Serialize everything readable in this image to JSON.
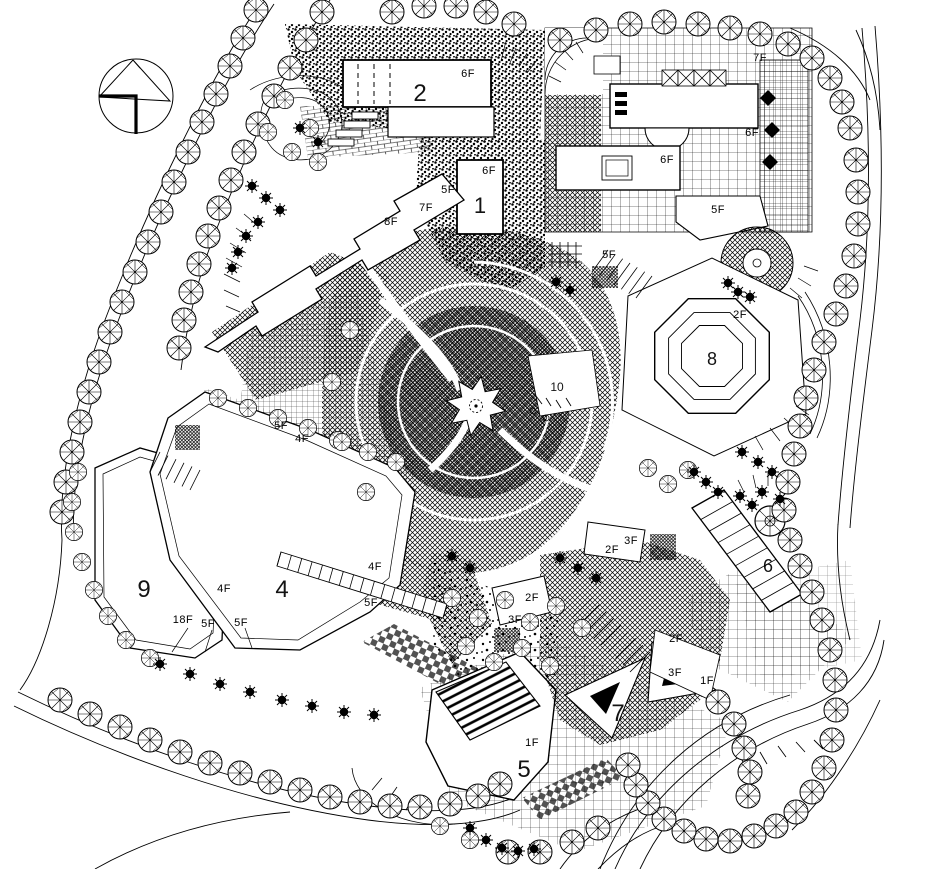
{
  "drawing": {
    "kind": "architectural masterplan site plan",
    "paper_color": "#ffffff",
    "ink_color": "#000000",
    "north_arrow_icon": "north-arrow"
  },
  "plan": {
    "building_numbers": [
      {
        "text": "1",
        "x": 480,
        "y": 213,
        "size": 22
      },
      {
        "text": "2",
        "x": 420,
        "y": 101,
        "size": 24
      },
      {
        "text": "4",
        "x": 282,
        "y": 597,
        "size": 24
      },
      {
        "text": "5",
        "x": 524,
        "y": 777,
        "size": 24
      },
      {
        "text": "6",
        "x": 768,
        "y": 572,
        "size": 18
      },
      {
        "text": "7",
        "x": 618,
        "y": 721,
        "size": 24
      },
      {
        "text": "8",
        "x": 712,
        "y": 365,
        "size": 18
      },
      {
        "text": "9",
        "x": 144,
        "y": 597,
        "size": 24
      },
      {
        "text": "10",
        "x": 557,
        "y": 391,
        "size": 12
      }
    ],
    "floor_labels": [
      {
        "text": "6F",
        "x": 468,
        "y": 77
      },
      {
        "text": "6F",
        "x": 489,
        "y": 174
      },
      {
        "text": "5F",
        "x": 448,
        "y": 193
      },
      {
        "text": "7F",
        "x": 426,
        "y": 211
      },
      {
        "text": "8F",
        "x": 391,
        "y": 225
      },
      {
        "text": "7F",
        "x": 760,
        "y": 61
      },
      {
        "text": "6F",
        "x": 752,
        "y": 136
      },
      {
        "text": "6F",
        "x": 667,
        "y": 163
      },
      {
        "text": "5F",
        "x": 718,
        "y": 213
      },
      {
        "text": "5F",
        "x": 609,
        "y": 258
      },
      {
        "text": "2F",
        "x": 740,
        "y": 318
      },
      {
        "text": "5F",
        "x": 281,
        "y": 429
      },
      {
        "text": "4F",
        "x": 302,
        "y": 442
      },
      {
        "text": "4F",
        "x": 375,
        "y": 570
      },
      {
        "text": "5F",
        "x": 371,
        "y": 606
      },
      {
        "text": "4F",
        "x": 224,
        "y": 592
      },
      {
        "text": "18F",
        "x": 183,
        "y": 623
      },
      {
        "text": "5F",
        "x": 208,
        "y": 627
      },
      {
        "text": "5F",
        "x": 241,
        "y": 626
      },
      {
        "text": "3F",
        "x": 631,
        "y": 544
      },
      {
        "text": "2F",
        "x": 612,
        "y": 553
      },
      {
        "text": "2F",
        "x": 532,
        "y": 601
      },
      {
        "text": "3F",
        "x": 515,
        "y": 623
      },
      {
        "text": "2F",
        "x": 676,
        "y": 642
      },
      {
        "text": "3F",
        "x": 675,
        "y": 676
      },
      {
        "text": "1F",
        "x": 707,
        "y": 684
      },
      {
        "text": "1F",
        "x": 532,
        "y": 746
      }
    ]
  }
}
